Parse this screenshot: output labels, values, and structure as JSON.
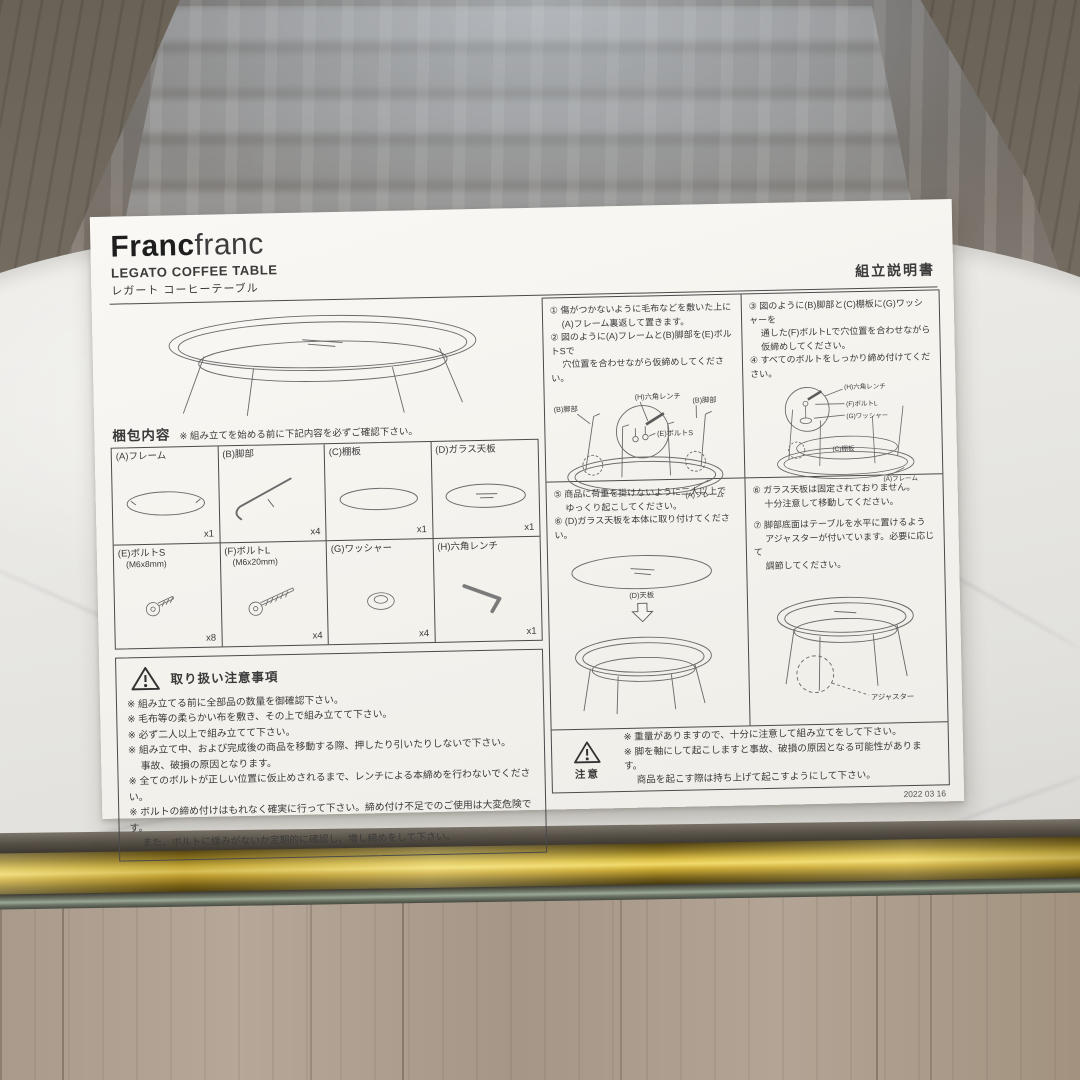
{
  "scene": {
    "background": {
      "reflection": "glass-table-window-reflection",
      "tabletop": "white-marble-tabletop",
      "frame_bar": "brass-table-frame-bar",
      "floor": "wood-floor"
    },
    "colors": {
      "brass": "#d8bc44",
      "marble": "#e9e8e4",
      "paper": "#f6f4f0",
      "ink": "#3a3a3a"
    }
  },
  "paper": {
    "brand_bold": "Franc",
    "brand_light": "franc",
    "product_en": "LEGATO COFFEE TABLE",
    "product_jp": "レガート コーヒーテーブル",
    "doc_title": "組立説明書",
    "packing": {
      "heading": "梱包内容",
      "note": "※ 組み立てを始める前に下記内容を必ずご確認下さい。",
      "items": [
        {
          "label": "(A)フレーム",
          "sub": "",
          "qty": "x1"
        },
        {
          "label": "(B)脚部",
          "sub": "",
          "qty": "x4"
        },
        {
          "label": "(C)棚板",
          "sub": "",
          "qty": "x1"
        },
        {
          "label": "(D)ガラス天板",
          "sub": "",
          "qty": "x1"
        },
        {
          "label": "(E)ボルトS",
          "sub": "(M6x8mm)",
          "qty": "x8"
        },
        {
          "label": "(F)ボルトL",
          "sub": "(M6x20mm)",
          "qty": "x4"
        },
        {
          "label": "(G)ワッシャー",
          "sub": "",
          "qty": "x4"
        },
        {
          "label": "(H)六角レンチ",
          "sub": "",
          "qty": "x1"
        }
      ]
    },
    "handling": {
      "title": "取り扱い注意事項",
      "lines": [
        "※ 組み立てる前に全部品の数量を御確認下さい。",
        "※ 毛布等の柔らかい布を敷き、その上で組み立てて下さい。",
        "※ 必ず二人以上で組み立てて下さい。",
        "※ 組み立て中、および完成後の商品を移動する際、押したり引いたりしないで下さい。",
        "　 事故、破損の原因となります。",
        "※ 全てのボルトが正しい位置に仮止めされるまで、レンチによる本締めを行わないでください。",
        "※ ボルトの締め付けはもれなく確実に行って下さい。締め付け不足でのご使用は大変危険です。",
        "　 また、ボルトに緩みがないか定期的に確認し、増し締めをして下さい。"
      ]
    },
    "steps": {
      "s12": [
        "① 傷がつかないように毛布などを敷いた上に",
        "　 (A)フレーム裏返して置きます。",
        "② 図のように(A)フレームと(B)脚部を(E)ボルトSで",
        "　 穴位置を合わせながら仮締めしてください。"
      ],
      "s34": [
        "③ 図のように(B)脚部と(C)棚板に(G)ワッシャーを",
        "　 通した(F)ボルトLで穴位置を合わせながら",
        "　 仮締めしてください。",
        "④ すべてのボルトをしっかり締め付けてください。"
      ],
      "s56": [
        "⑤ 商品に荷重を掛けないように二人以上で",
        "　 ゆっくり起こしてください。",
        "⑥ (D)ガラス天板を本体に取り付けてください。"
      ],
      "s67": [
        "⑥ ガラス天板は固定されておりません。",
        "　 十分注意して移動してください。",
        "⑦ 脚部底面はテーブルを水平に置けるよう",
        "　 アジャスターが付いています。必要に応じて",
        "　 調節してください。"
      ]
    },
    "diagram_labels": {
      "d12": {
        "leg_left": "(B)脚部",
        "wrench": "(H)六角レンチ",
        "bolt_s": "(E)ボルトS",
        "leg_right": "(B)脚部",
        "frame": "(A)フレーム"
      },
      "d34": {
        "wrench": "(H)六角レンチ",
        "bolt_l": "(F)ボルトL",
        "washer": "(G)ワッシャー",
        "shelf": "(C)棚板",
        "frame": "(A)フレーム"
      },
      "d56": {
        "top": "(D)天板"
      },
      "d67": {
        "adjuster": "アジャスター"
      }
    },
    "caution": {
      "label": "注意",
      "lines": [
        "※ 重量がありますので、十分に注意して組み立てをして下さい。",
        "※ 脚を軸にして起こしますと事故、破損の原因となる可能性があります。",
        "　 商品を起こす際は持ち上げて起こすようにして下さい。"
      ]
    },
    "date": "2022 03 16"
  }
}
